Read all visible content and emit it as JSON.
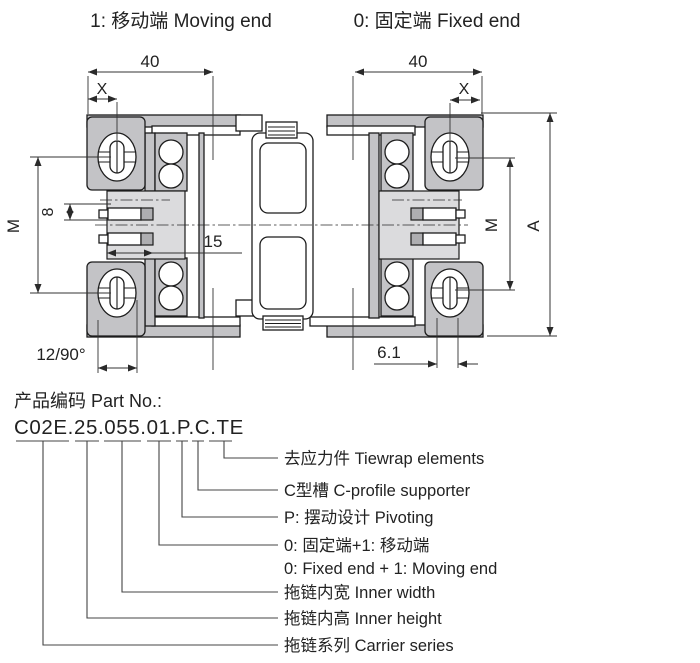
{
  "header": {
    "moving_end_label": "1: 移动端 Moving end",
    "fixed_end_label": "0: 固定端 Fixed end"
  },
  "dims": {
    "width_left": "40",
    "width_right": "40",
    "x_left": "X",
    "x_right": "X",
    "m_left": "M",
    "m_right": "M",
    "pitch": "8",
    "inner_width": "15",
    "height": "A",
    "slot": "12/90°",
    "hole": "6.1"
  },
  "part": {
    "title": "产品编码 Part No.:",
    "code": "C02E.25.055.01.P.C.TE",
    "callouts": [
      {
        "label": "去应力件 Tiewrap elements"
      },
      {
        "label": "C型槽 C-profile supporter"
      },
      {
        "label": "P: 摆动设计 Pivoting"
      },
      {
        "label": "0: 固定端+1: 移动端"
      },
      {
        "label": "0: Fixed end + 1: Moving end"
      },
      {
        "label": "拖链内宽 Inner width"
      },
      {
        "label": "拖链内高 Inner height"
      },
      {
        "label": "拖链系列 Carrier series"
      }
    ]
  },
  "colors": {
    "fill_gray": "#c3c3c6",
    "fill_light": "#dbdbdd",
    "line": "#1c1c1c",
    "dim_line": "#333333"
  }
}
